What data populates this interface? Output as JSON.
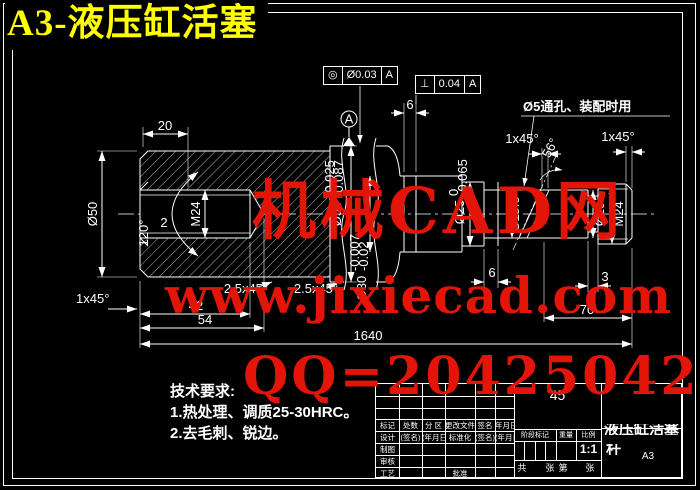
{
  "header": {
    "title": "A3-液压缸活塞"
  },
  "watermark": {
    "line1": "机械CAD网",
    "line2": "www.jixiecad.com",
    "line3": "QQ=20425042",
    "color": "#e31408"
  },
  "colors": {
    "background": "#000000",
    "line": "#ffffff",
    "title": "#ffff00"
  },
  "gdt": {
    "concentricity": {
      "symbol": "◎",
      "value": "Ø0.03",
      "datum": "A"
    },
    "perpendicularity": {
      "symbol": "⊥",
      "value": "0.04",
      "datum": "A"
    },
    "datum_label": "A"
  },
  "notes": {
    "hole_note": "Ø5通孔、装配时用"
  },
  "dims": {
    "d20": "20",
    "d6_top": "6",
    "d2": "2",
    "d42": "42",
    "d54": "54",
    "d1640": "1640",
    "d70": "70",
    "d6_bot": "6",
    "d3": "3",
    "chamfer_left": "1x45°",
    "chamfer_m1": "2.5x45°",
    "chamfer_m2": "2.5x45°",
    "chamfer_r1": "1x45°",
    "chamfer_r2": "1x45°",
    "angle56": "56°",
    "angle120": "120°",
    "dia50": "Ø50",
    "m24_left": "M24",
    "dia56": {
      "v": "Ø56",
      "tu": "-0.025",
      "tl": "-0.087"
    },
    "dia30": {
      "v": "Ø30",
      "tu": "-0.007",
      "tl": "-0.02"
    },
    "dia25": {
      "v": "Ø25",
      "tu": "0",
      "tl": "-0.065"
    },
    "dia19_5": "Ø19.5",
    "dia19": "Ø19",
    "m24_right": "M24"
  },
  "tech": {
    "title": "技术要求:",
    "item1": "1.热处理、调质25-30HRC。",
    "item2": "2.去毛刺、锐边。"
  },
  "tb": {
    "material": "45",
    "name1": "液压缸活塞",
    "name2": "杆",
    "sheet": "A3",
    "scale_value": "1:1",
    "r1": [
      "标记",
      "处数",
      "分 区",
      "更改文件号",
      "签名",
      "年月日"
    ],
    "r2": [
      "设计",
      "(签名)",
      "(年月日)",
      "标准化",
      "(签名)",
      "(年月日)"
    ],
    "r3": "制图",
    "r4": "审核",
    "r5": "工艺",
    "approve": "批准",
    "stage": "阶段标记",
    "weight": "重量",
    "scale": "比例",
    "s1": "共",
    "s2": "张",
    "s3": "第",
    "s4": "张"
  }
}
